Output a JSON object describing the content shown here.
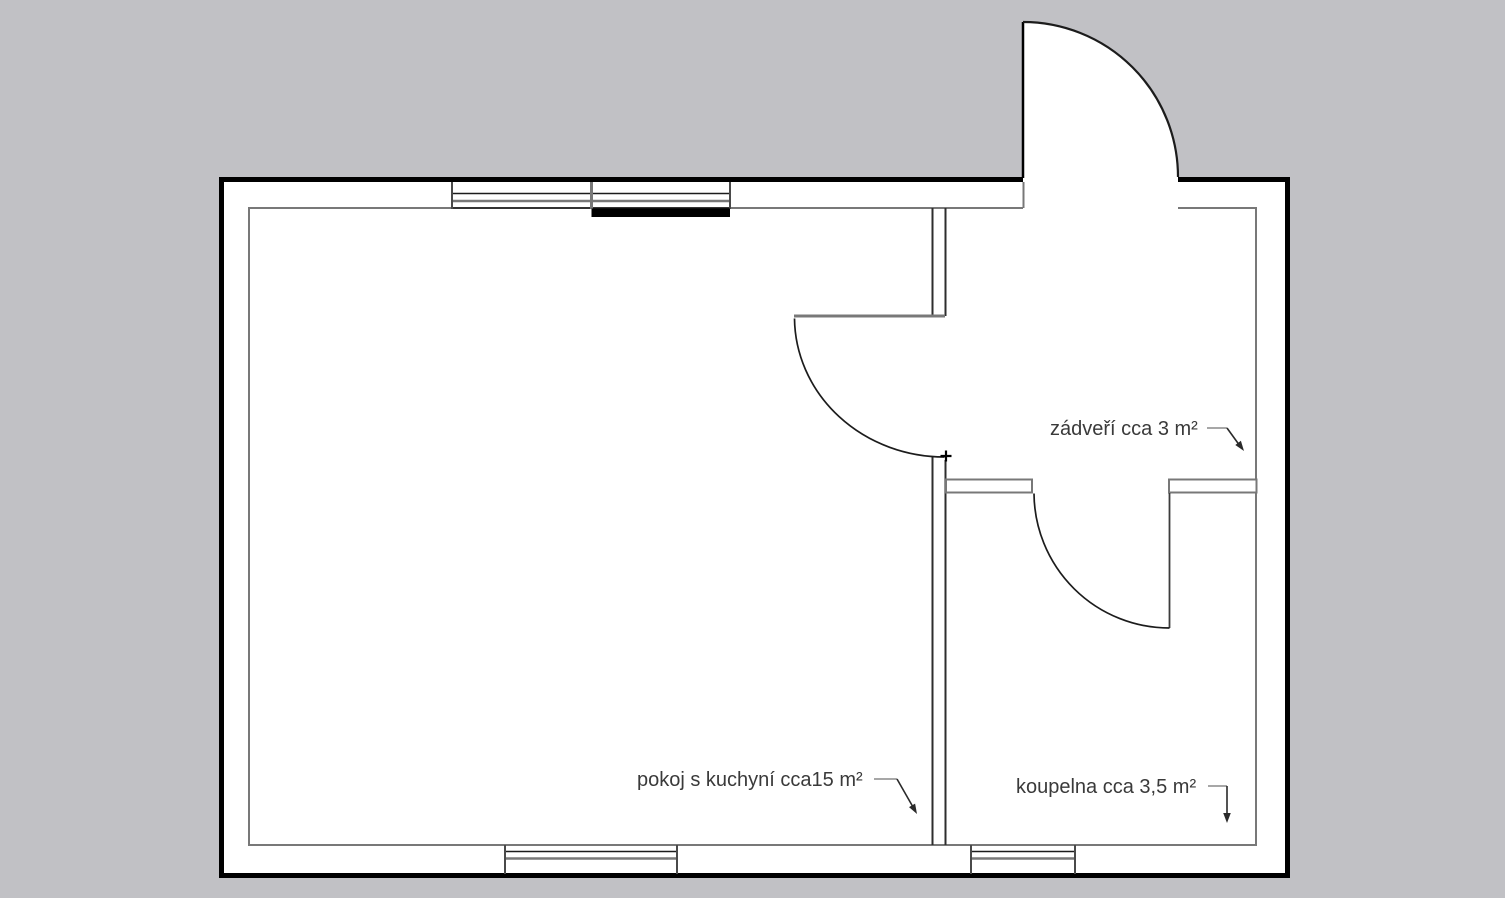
{
  "document_type": "floor-plan",
  "colors": {
    "bg": "#c1c1c5",
    "floor": "#ffffff",
    "wall": "#000000",
    "inner": "#787878",
    "text": "#3a3a3a",
    "leader": "#8a8a8a",
    "leader_dark": "#2a2a2a"
  },
  "labels": {
    "room_kitchen": "pokoj s kuchyní cca15 m²",
    "vestibule": "zádveří cca 3 m²",
    "bathroom": "koupelna cca 3,5 m²"
  },
  "rooms": [
    {
      "name": "pokoj s kuchyní",
      "area": "cca15 m²"
    },
    {
      "name": "zádveří",
      "area": "cca 3 m²"
    },
    {
      "name": "koupelna",
      "area": "cca 3,5 m²"
    }
  ]
}
